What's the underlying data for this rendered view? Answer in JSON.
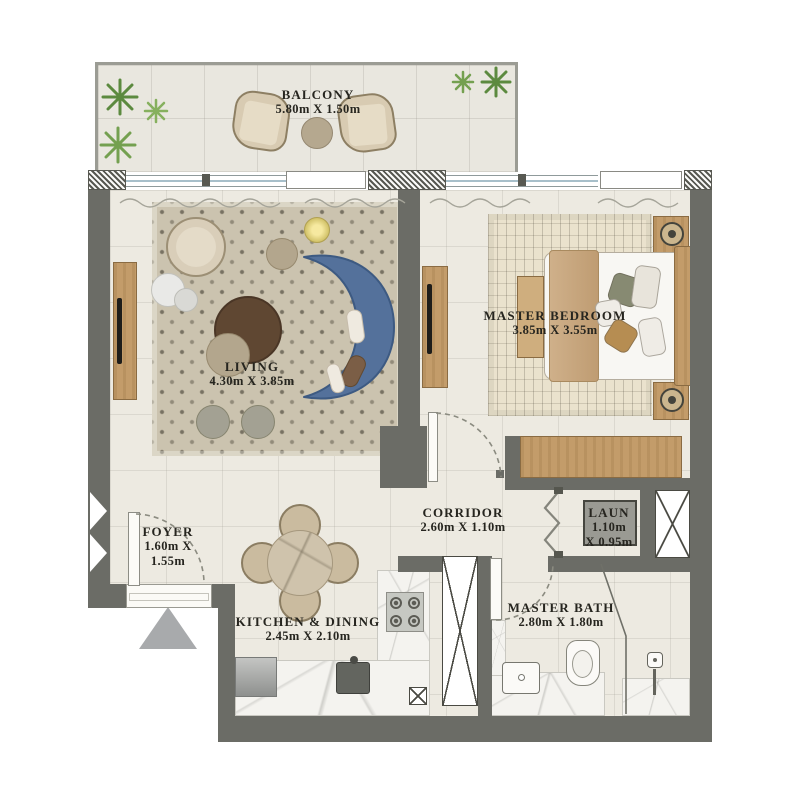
{
  "rooms": {
    "balcony": {
      "name": "BALCONY",
      "dims": "5.80m X 1.50m"
    },
    "living": {
      "name": "LIVING",
      "dims": "4.30m X 3.85m"
    },
    "master_bedroom": {
      "name": "MASTER BEDROOM",
      "dims": "3.85m X 3.55m"
    },
    "corridor": {
      "name": "CORRIDOR",
      "dims": "2.60m X 1.10m"
    },
    "foyer": {
      "name": "FOYER",
      "dims_line1": "1.60m X",
      "dims_line2": "1.55m"
    },
    "laundry": {
      "name": "LAUN",
      "dims_line1": "1.10m",
      "dims_line2": "X 0.95m"
    },
    "kitchen": {
      "name": "KITCHEN & DINING",
      "dims": "2.45m X 2.10m"
    },
    "master_bath": {
      "name": "MASTER BATH",
      "dims": "2.80m X 1.80m"
    }
  },
  "icons": [
    "plant-icon",
    "washer-icon",
    "stove-icon",
    "sink-icon",
    "fridge-icon",
    "toilet-icon",
    "vanity-sink-icon",
    "shower-head-icon",
    "table-lamp-icon",
    "floor-lamp-icon",
    "tv-icon",
    "entry-arrow-icon",
    "bifold-door-icon",
    "shaft-x-icon",
    "door-swing-arc-icon",
    "curtain-icon"
  ],
  "colors": {
    "wall": "#6b6c66",
    "floor": "#edeae1",
    "balcony_floor": "#e9e7df",
    "rug_living": "#cbc3af",
    "rug_bedroom": "#eae2cd",
    "sofa_blue": "#54719b",
    "wood": "#c39c6a",
    "coffee_table": "#5f4732",
    "plant_green": "#74a050",
    "entry_marker": "#a8aaac",
    "glass": "#a7bfca",
    "text": "#26251f"
  }
}
